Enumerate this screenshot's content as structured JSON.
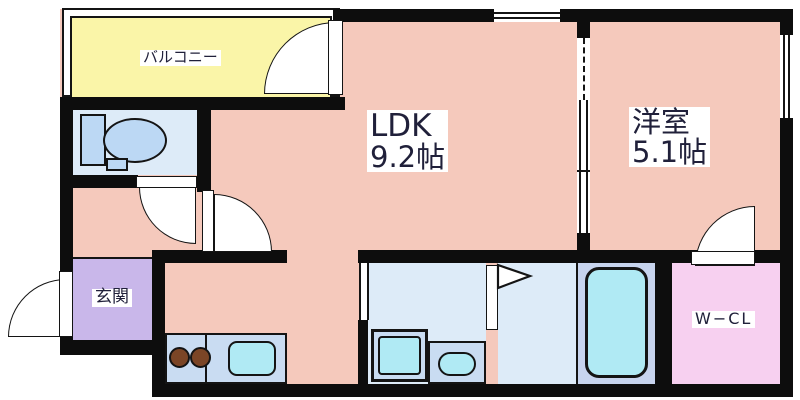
{
  "plan_type": "japanese-apartment-floor-plan",
  "rooms": {
    "balcony": {
      "label": "バルコニー"
    },
    "ldk": {
      "label": "LDK",
      "size": "9.2帖"
    },
    "western_room": {
      "label": "洋室",
      "size": "5.1帖"
    },
    "entrance": {
      "label": "玄関"
    },
    "walk_in_closet": {
      "label": "W−CL"
    },
    "toilet": {
      "label": ""
    },
    "washroom": {
      "label": ""
    },
    "bathroom": {
      "label": ""
    }
  },
  "fixtures": [
    "toilet-icon",
    "stove-two-burner-icon",
    "kitchen-sink-icon",
    "washing-machine-pan-icon",
    "washbasin-icon",
    "bathtub-icon",
    "folding-door-flag-icon"
  ],
  "colors": {
    "floor_pink": "#F5C9BC",
    "balcony_yellow": "#FAF5A8",
    "wet_room_blue": "#DDEBF8",
    "fixture_panel_blue": "#C9DCF2",
    "fixture_cyan": "#B0EAF4",
    "tub_platform_blue": "#C7D4EE",
    "entrance_purple": "#C9B7EA",
    "wcl_pink": "#F7D0F0",
    "wall_black": "#0D0D0D",
    "toilet_fill": "#BCD8F4",
    "burner_brown": "#7B4526"
  }
}
